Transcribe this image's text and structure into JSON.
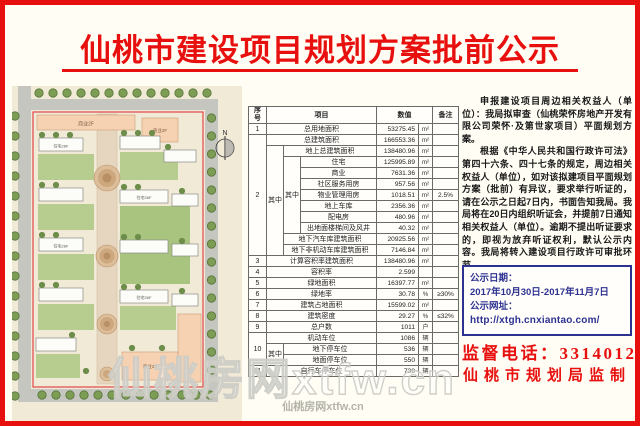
{
  "title": "仙桃市建设项目规划方案批前公示",
  "colors": {
    "accent_red": "#e8100e",
    "deep_blue": "#2d3190",
    "boundary_red": "#e04848"
  },
  "map": {
    "north_label": "N",
    "commercial_label": "商业2F",
    "residential_label": "住宅26F"
  },
  "table": {
    "header": {
      "seq": "序号",
      "item": "项目",
      "value": "数值",
      "remark": "备注"
    },
    "zhong": "其中",
    "rows": {
      "r1": {
        "seq": "1",
        "item": "总用地面积",
        "value": "53275.45",
        "unit": "m²",
        "remark": ""
      },
      "r2": {
        "seq": "2",
        "item": "总建筑面积",
        "value": "166553.36",
        "unit": "m²",
        "remark": ""
      },
      "r3": {
        "item": "地上总建筑面积",
        "value": "138480.96",
        "unit": "m²",
        "remark": ""
      },
      "r4": {
        "item": "住宅",
        "value": "125995.89",
        "unit": "m²",
        "remark": ""
      },
      "r5": {
        "item": "商业",
        "value": "7631.36",
        "unit": "m²",
        "remark": ""
      },
      "r6": {
        "item": "社区服务用房",
        "value": "957.56",
        "unit": "m²",
        "remark": ""
      },
      "r7": {
        "item": "物业管理用房",
        "value": "1018.51",
        "unit": "m²",
        "remark": "2.5%"
      },
      "r8": {
        "item": "地上车库",
        "value": "2356.36",
        "unit": "m²",
        "remark": ""
      },
      "r9": {
        "item": "配电房",
        "value": "480.96",
        "unit": "m²",
        "remark": ""
      },
      "r10": {
        "item": "出地面楼梯间及风井",
        "value": "40.32",
        "unit": "m²",
        "remark": ""
      },
      "r11": {
        "item": "地下汽车库建筑面积",
        "value": "20925.56",
        "unit": "m²",
        "remark": ""
      },
      "r12": {
        "item": "地下非机动车库建筑面积",
        "value": "7146.84",
        "unit": "m²",
        "remark": ""
      },
      "r13": {
        "seq": "3",
        "item": "计算容积率建筑面积",
        "value": "138480.96",
        "unit": "m²",
        "remark": ""
      },
      "r14": {
        "seq": "4",
        "item": "容积率",
        "value": "2.599",
        "unit": "",
        "remark": ""
      },
      "r15": {
        "seq": "5",
        "item": "绿地面积",
        "value": "16397.77",
        "unit": "m²",
        "remark": ""
      },
      "r16": {
        "seq": "6",
        "item": "绿地率",
        "value": "30.78",
        "unit": "%",
        "remark": "≥30%"
      },
      "r17": {
        "seq": "7",
        "item": "建筑占地面积",
        "value": "15599.02",
        "unit": "m²",
        "remark": ""
      },
      "r18": {
        "seq": "8",
        "item": "建筑密度",
        "value": "29.27",
        "unit": "%",
        "remark": "≤32%"
      },
      "r19": {
        "seq": "9",
        "item": "总户数",
        "value": "1011",
        "unit": "户",
        "remark": ""
      },
      "r20": {
        "seq": "10",
        "item": "机动车位",
        "value": "1086",
        "unit": "辆",
        "remark": ""
      },
      "r21": {
        "item": "地下停车位",
        "value": "536",
        "unit": "辆",
        "remark": ""
      },
      "r22": {
        "item": "地面停车位",
        "value": "550",
        "unit": "辆",
        "remark": ""
      },
      "r23": {
        "seq": "11",
        "item": "自行车停车位",
        "value": "738",
        "unit": "辆",
        "remark": ""
      }
    }
  },
  "notice": {
    "para1": "申报建设项目周边相关权益人（单位）：我局拟审查（仙桃荣怀房地产开发有限公司荣怀·及第世家项目）平面规划方案。",
    "para2": "根据《中华人民共和国行政许可法》第四十六条、四十七条的规定，周边相关权益人（单位），如对该拟建项目平面规划方案（批前）有异议，要求举行听证的，请在公示之日起7日内，书面告知我局。我局将在20日内组织听证会，并提前7日通知相关权益人（单位）。逾期不提出听证要求的，即视为放弃听证权利，默认公示内容。我局将转入建设项目行政许可审批环节。",
    "date_label": "公示日期：",
    "date_value": "2017年10月30日-2017年11月7日",
    "url_label": "公示网址：",
    "url_value": "http://xtgh.cnxiantao.com/",
    "phone": "监督电话：3314012",
    "issuer": "仙桃市规划局监制"
  },
  "watermarks": {
    "large": "仙桃房网xtfw.cn",
    "small": "仙桃房网xtfw.cn"
  }
}
